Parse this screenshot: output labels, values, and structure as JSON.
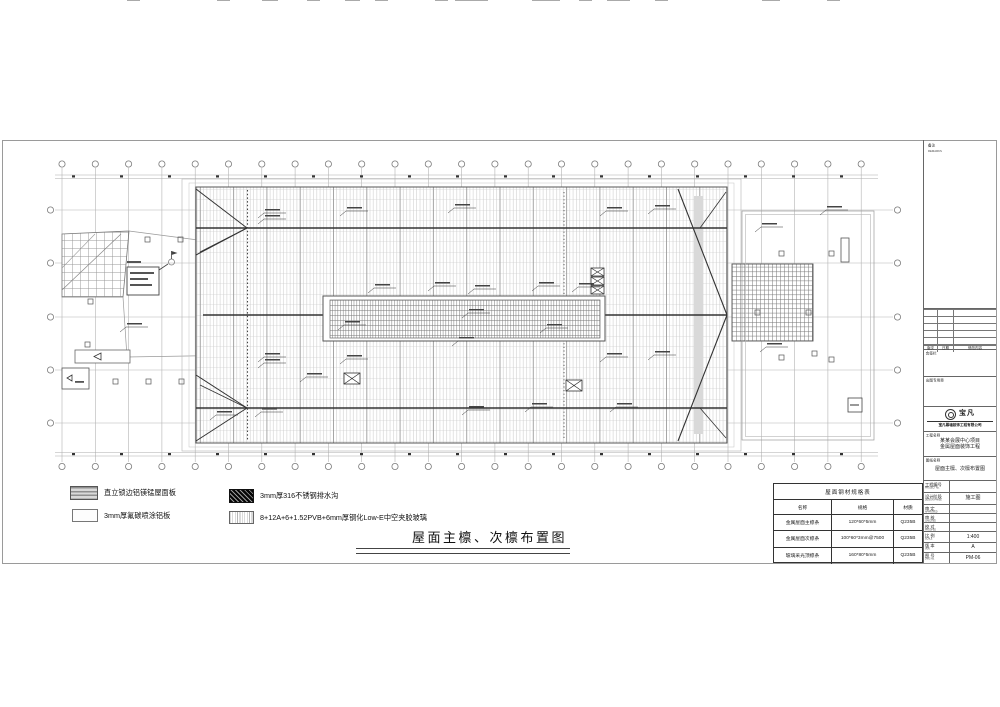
{
  "title": {
    "text": "屋面主檩、次檩布置图"
  },
  "legend": {
    "items": [
      {
        "label": "直立锁边铝镁锰屋面板",
        "swatch": "standing-seam-panel"
      },
      {
        "label": "3mm厚氟碳喷涂铝板",
        "swatch": "aluminum-panel"
      },
      {
        "label": "3mm厚316不锈钢排水沟",
        "swatch": "stainless-gutter"
      },
      {
        "label": "8+12A+6+1.52PVB+6mm厚钢化Low-E中空夹胶玻璃",
        "swatch": "insulated-glass"
      }
    ]
  },
  "spec_table": {
    "title": "屋面钢材规格表",
    "columns": [
      "名称",
      "规格",
      "材质"
    ],
    "rows": [
      [
        "金属屋面主檩条",
        "120*60*5mm",
        "Q235B"
      ],
      [
        "金属屋面次檩条",
        "100*60*3mm@7500",
        "Q235B"
      ],
      [
        "玻璃采光顶檩条",
        "160*80*5mm",
        "Q235B"
      ]
    ]
  },
  "title_block": {
    "notes_label": "备注",
    "notes_label_en": "REMARKS",
    "revision": {
      "rev": "版次",
      "date": "日期",
      "content": "修改内容"
    },
    "sign_box_label": "会签栏",
    "stamp_box_label": "出图专用章",
    "logo_text": "宝凡",
    "company": "宝凡幕墙装饰工程有限公司",
    "project_label": "工程名称",
    "project_label_en": "PROJECT",
    "project_name_line1": "某某会展中心项目",
    "project_name_line2": "金属屋面装饰工程",
    "dwg_title_label": "图纸名称",
    "dwg_title_label_en": "TITLE",
    "dwg_title": "屋面主檩、次檩布置图",
    "rows": [
      {
        "label": "工程编号",
        "en": "PROJECT No.",
        "value": ""
      },
      {
        "label": "设计阶段",
        "en": "DESIGN PHASE",
        "value": "施工图"
      },
      {
        "label": "审 定",
        "en": "APPROVED",
        "value": ""
      },
      {
        "label": "审 核",
        "en": "CHECKED",
        "value": ""
      },
      {
        "label": "校 对",
        "en": "PROOFED",
        "value": ""
      },
      {
        "label": "比 例",
        "en": "SCALE",
        "value": "1:400"
      },
      {
        "label": "版 本",
        "en": "VER.",
        "value": "A"
      },
      {
        "label": "图 号",
        "en": "DWG No.",
        "value": "PM-06"
      }
    ]
  }
}
